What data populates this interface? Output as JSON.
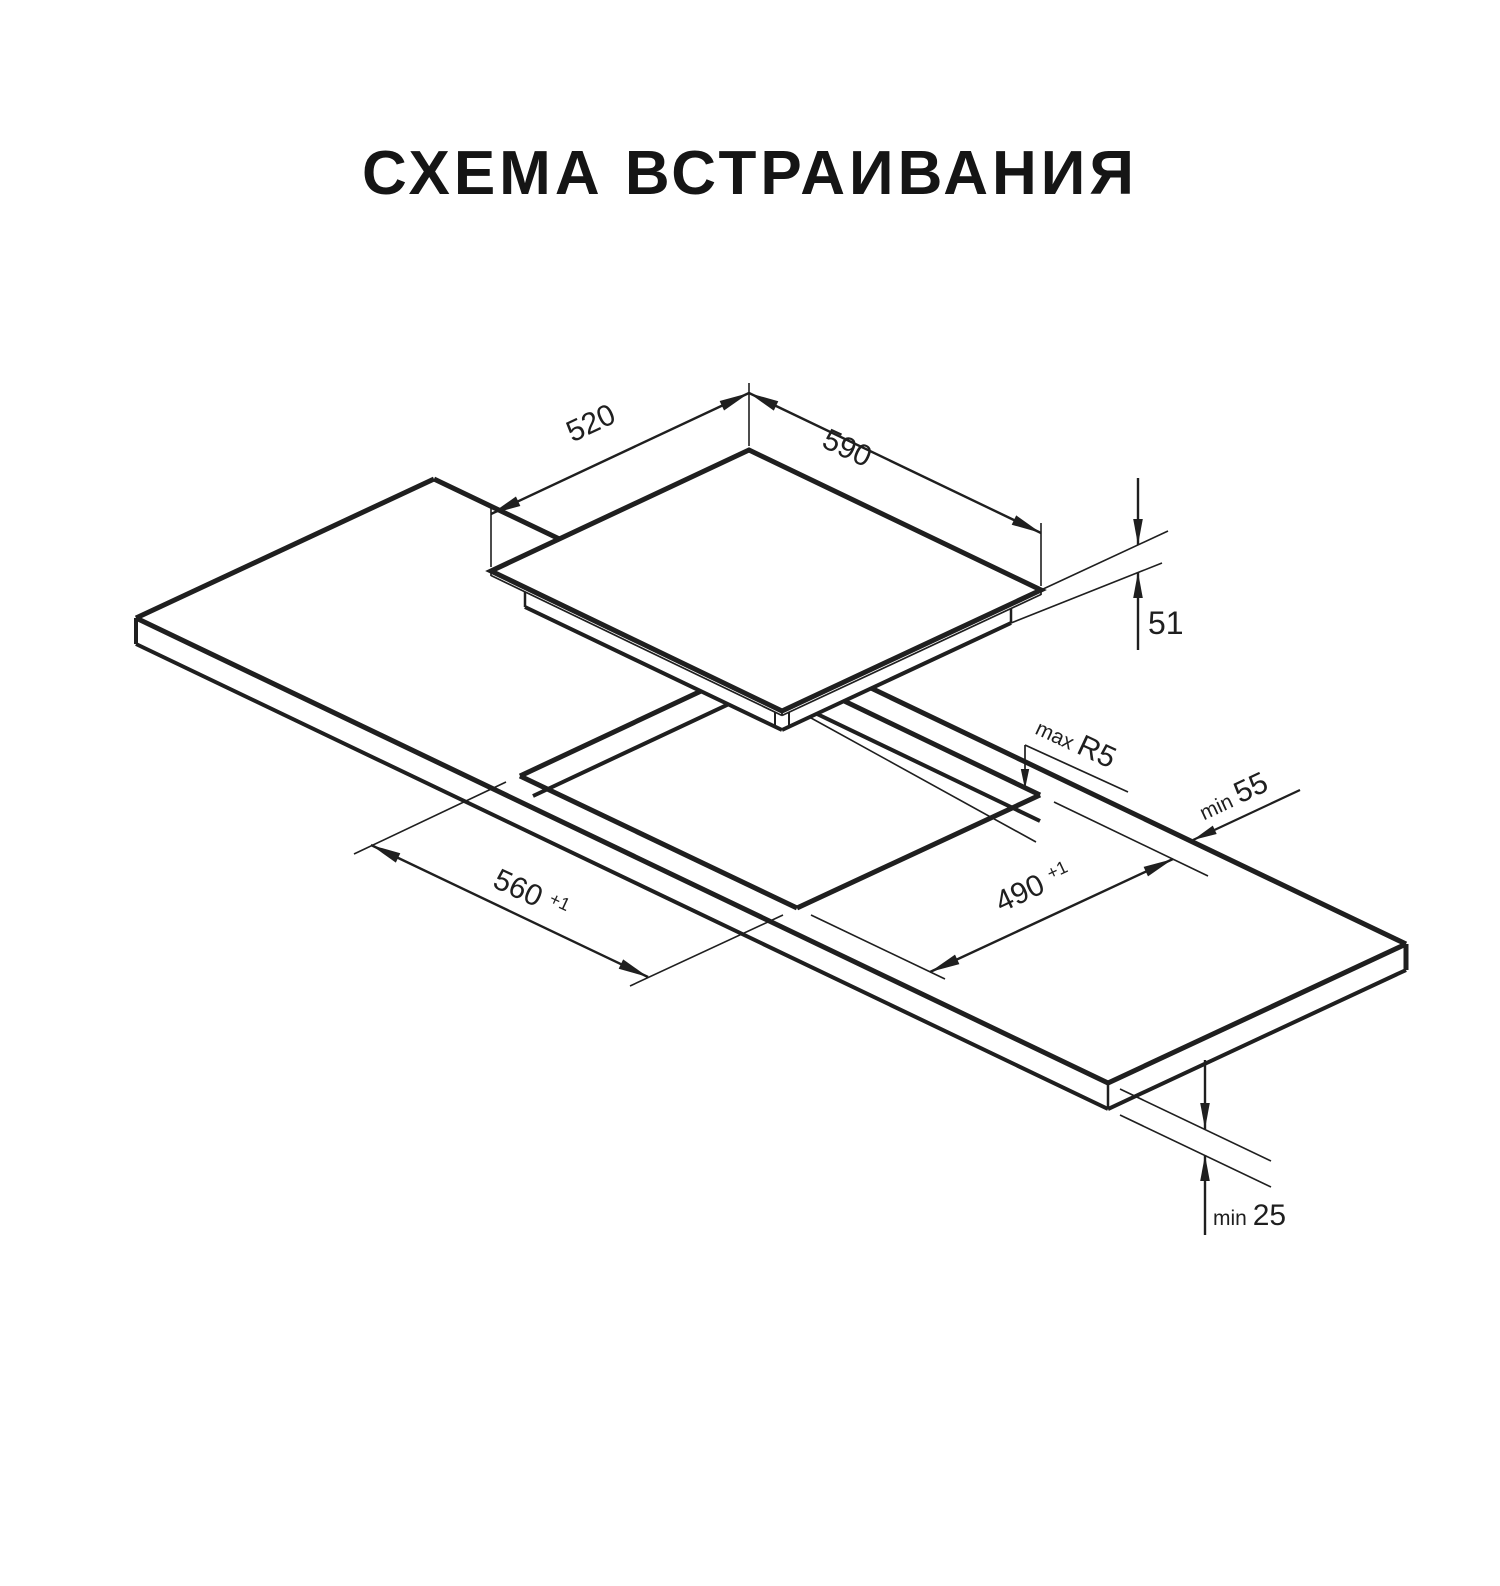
{
  "title": "СХЕМА ВСТРАИВАНИЯ",
  "diagram": {
    "type": "isometric-installation-drawing",
    "ink_color": "#1f1f1f",
    "background": "#ffffff",
    "dimensions": {
      "cooktop_width_mm": "590",
      "cooktop_depth_mm": "520",
      "cooktop_height_mm": "51",
      "cutout_length_mm": "560",
      "cutout_length_tolerance": "+1",
      "cutout_width_mm": "490",
      "cutout_width_tolerance": "+1",
      "cutout_corner_radius": "max R5",
      "edge_clearance_mm": "min 55",
      "countertop_thickness_mm": "min 25"
    },
    "labels": [
      {
        "id": "dim-label-520",
        "anchor": "middle",
        "x": 595,
        "y": 432,
        "rot": -25,
        "parts": [
          {
            "t": "520",
            "s": 30
          }
        ]
      },
      {
        "id": "dim-label-590",
        "anchor": "middle",
        "x": 843,
        "y": 457,
        "rot": 25,
        "parts": [
          {
            "t": "590",
            "s": 30
          }
        ]
      },
      {
        "id": "dim-label-51",
        "anchor": "start",
        "x": 1148,
        "y": 634,
        "rot": 0,
        "parts": [
          {
            "t": "51",
            "s": 32
          }
        ]
      },
      {
        "id": "dim-label-max-r5",
        "anchor": "middle",
        "x": 1072,
        "y": 751,
        "rot": 25,
        "parts": [
          {
            "t": "max ",
            "s": 21
          },
          {
            "t": "R5",
            "s": 30
          }
        ]
      },
      {
        "id": "dim-label-min-55",
        "anchor": "middle",
        "x": 1237,
        "y": 805,
        "rot": -25,
        "parts": [
          {
            "t": "min ",
            "s": 21
          },
          {
            "t": "55",
            "s": 30
          }
        ]
      },
      {
        "id": "dim-label-560",
        "anchor": "middle",
        "x": 527,
        "y": 903,
        "rot": 25,
        "parts": [
          {
            "t": "560 ",
            "s": 30
          },
          {
            "t": "+1",
            "s": 18,
            "sup": true
          }
        ]
      },
      {
        "id": "dim-label-490",
        "anchor": "middle",
        "x": 1037,
        "y": 896,
        "rot": -25,
        "parts": [
          {
            "t": "490 ",
            "s": 30
          },
          {
            "t": "+1",
            "s": 18,
            "sup": true
          }
        ]
      },
      {
        "id": "dim-label-min-25",
        "anchor": "start",
        "x": 1213,
        "y": 1225,
        "rot": 0,
        "parts": [
          {
            "t": "min ",
            "s": 21
          },
          {
            "t": "25",
            "s": 30
          }
        ]
      }
    ]
  }
}
